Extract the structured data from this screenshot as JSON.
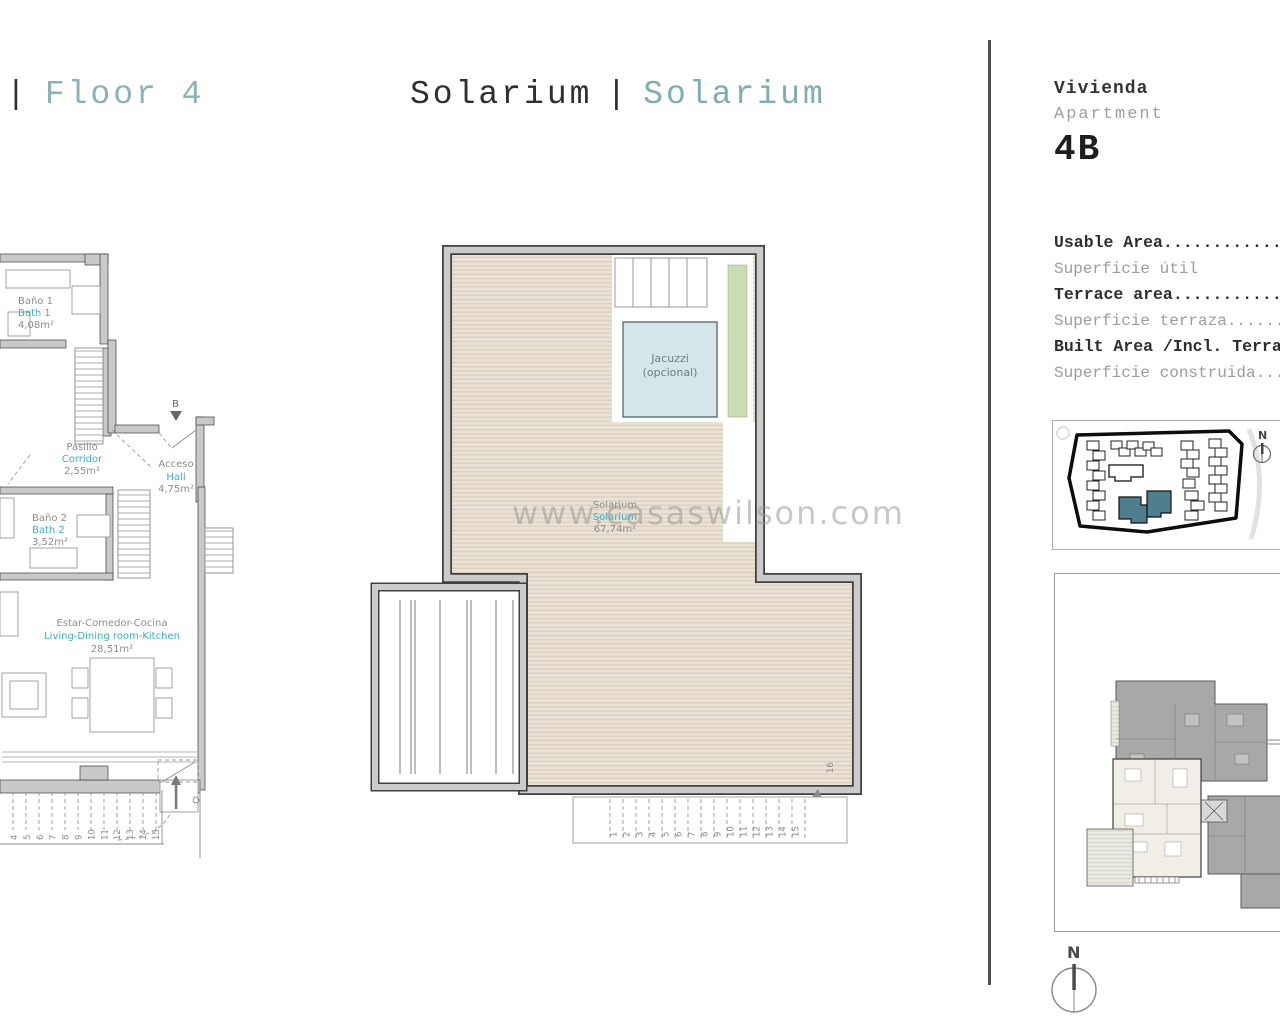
{
  "header": {
    "floor_divider": "|",
    "floor_title": "Floor 4",
    "center_title_1": "Solarium",
    "center_divider": "|",
    "center_title_2": "Solarium",
    "vivienda": "Vivienda",
    "apartment": "Apartment",
    "unit": "4B"
  },
  "area_table": {
    "rows": [
      {
        "en": "Usable Area.....................",
        "es": "Superficie útil"
      },
      {
        "en": "Terrace area....................",
        "es": "Superficie terraza.........."
      },
      {
        "en": "Built Area /Incl. Terrace.......",
        "es": "Superficie construida......."
      }
    ]
  },
  "watermark": "www.casaswilson.com",
  "floor_plan": {
    "rooms": {
      "bath1": {
        "es": "Baño 1",
        "en": "Bath 1",
        "area": "4,08m²"
      },
      "corridor": {
        "es": "Pasillo",
        "en": "Corridor",
        "area": "2,55m²"
      },
      "hall": {
        "es": "Acceso",
        "en": "Hall",
        "area": "4,75m²"
      },
      "bath2": {
        "es": "Baño 2",
        "en": "Bath 2",
        "area": "3,52m²"
      },
      "living": {
        "es": "Estar-Comedor-Cocina",
        "en": "Living-Dining room-Kitchen",
        "area": "28,51m²"
      }
    },
    "section_marker": "B",
    "stair_numbers": [
      "4",
      "5",
      "6",
      "7",
      "8",
      "9",
      "10",
      "11",
      "12",
      "13",
      "14",
      "15"
    ]
  },
  "solarium_plan": {
    "room": {
      "es": "Solarium",
      "en": "Solarium",
      "area": "67,74m²"
    },
    "jacuzzi": {
      "line1": "Jacuzzi",
      "line2": "(opcional)"
    },
    "stair_numbers": [
      "1",
      "2",
      "3",
      "4",
      "5",
      "6",
      "7",
      "8",
      "9",
      "10",
      "11",
      "12",
      "13",
      "14",
      "15"
    ],
    "step_16": "16"
  },
  "site_plan": {
    "compass_n": "N"
  },
  "compass": {
    "n": "N"
  }
}
